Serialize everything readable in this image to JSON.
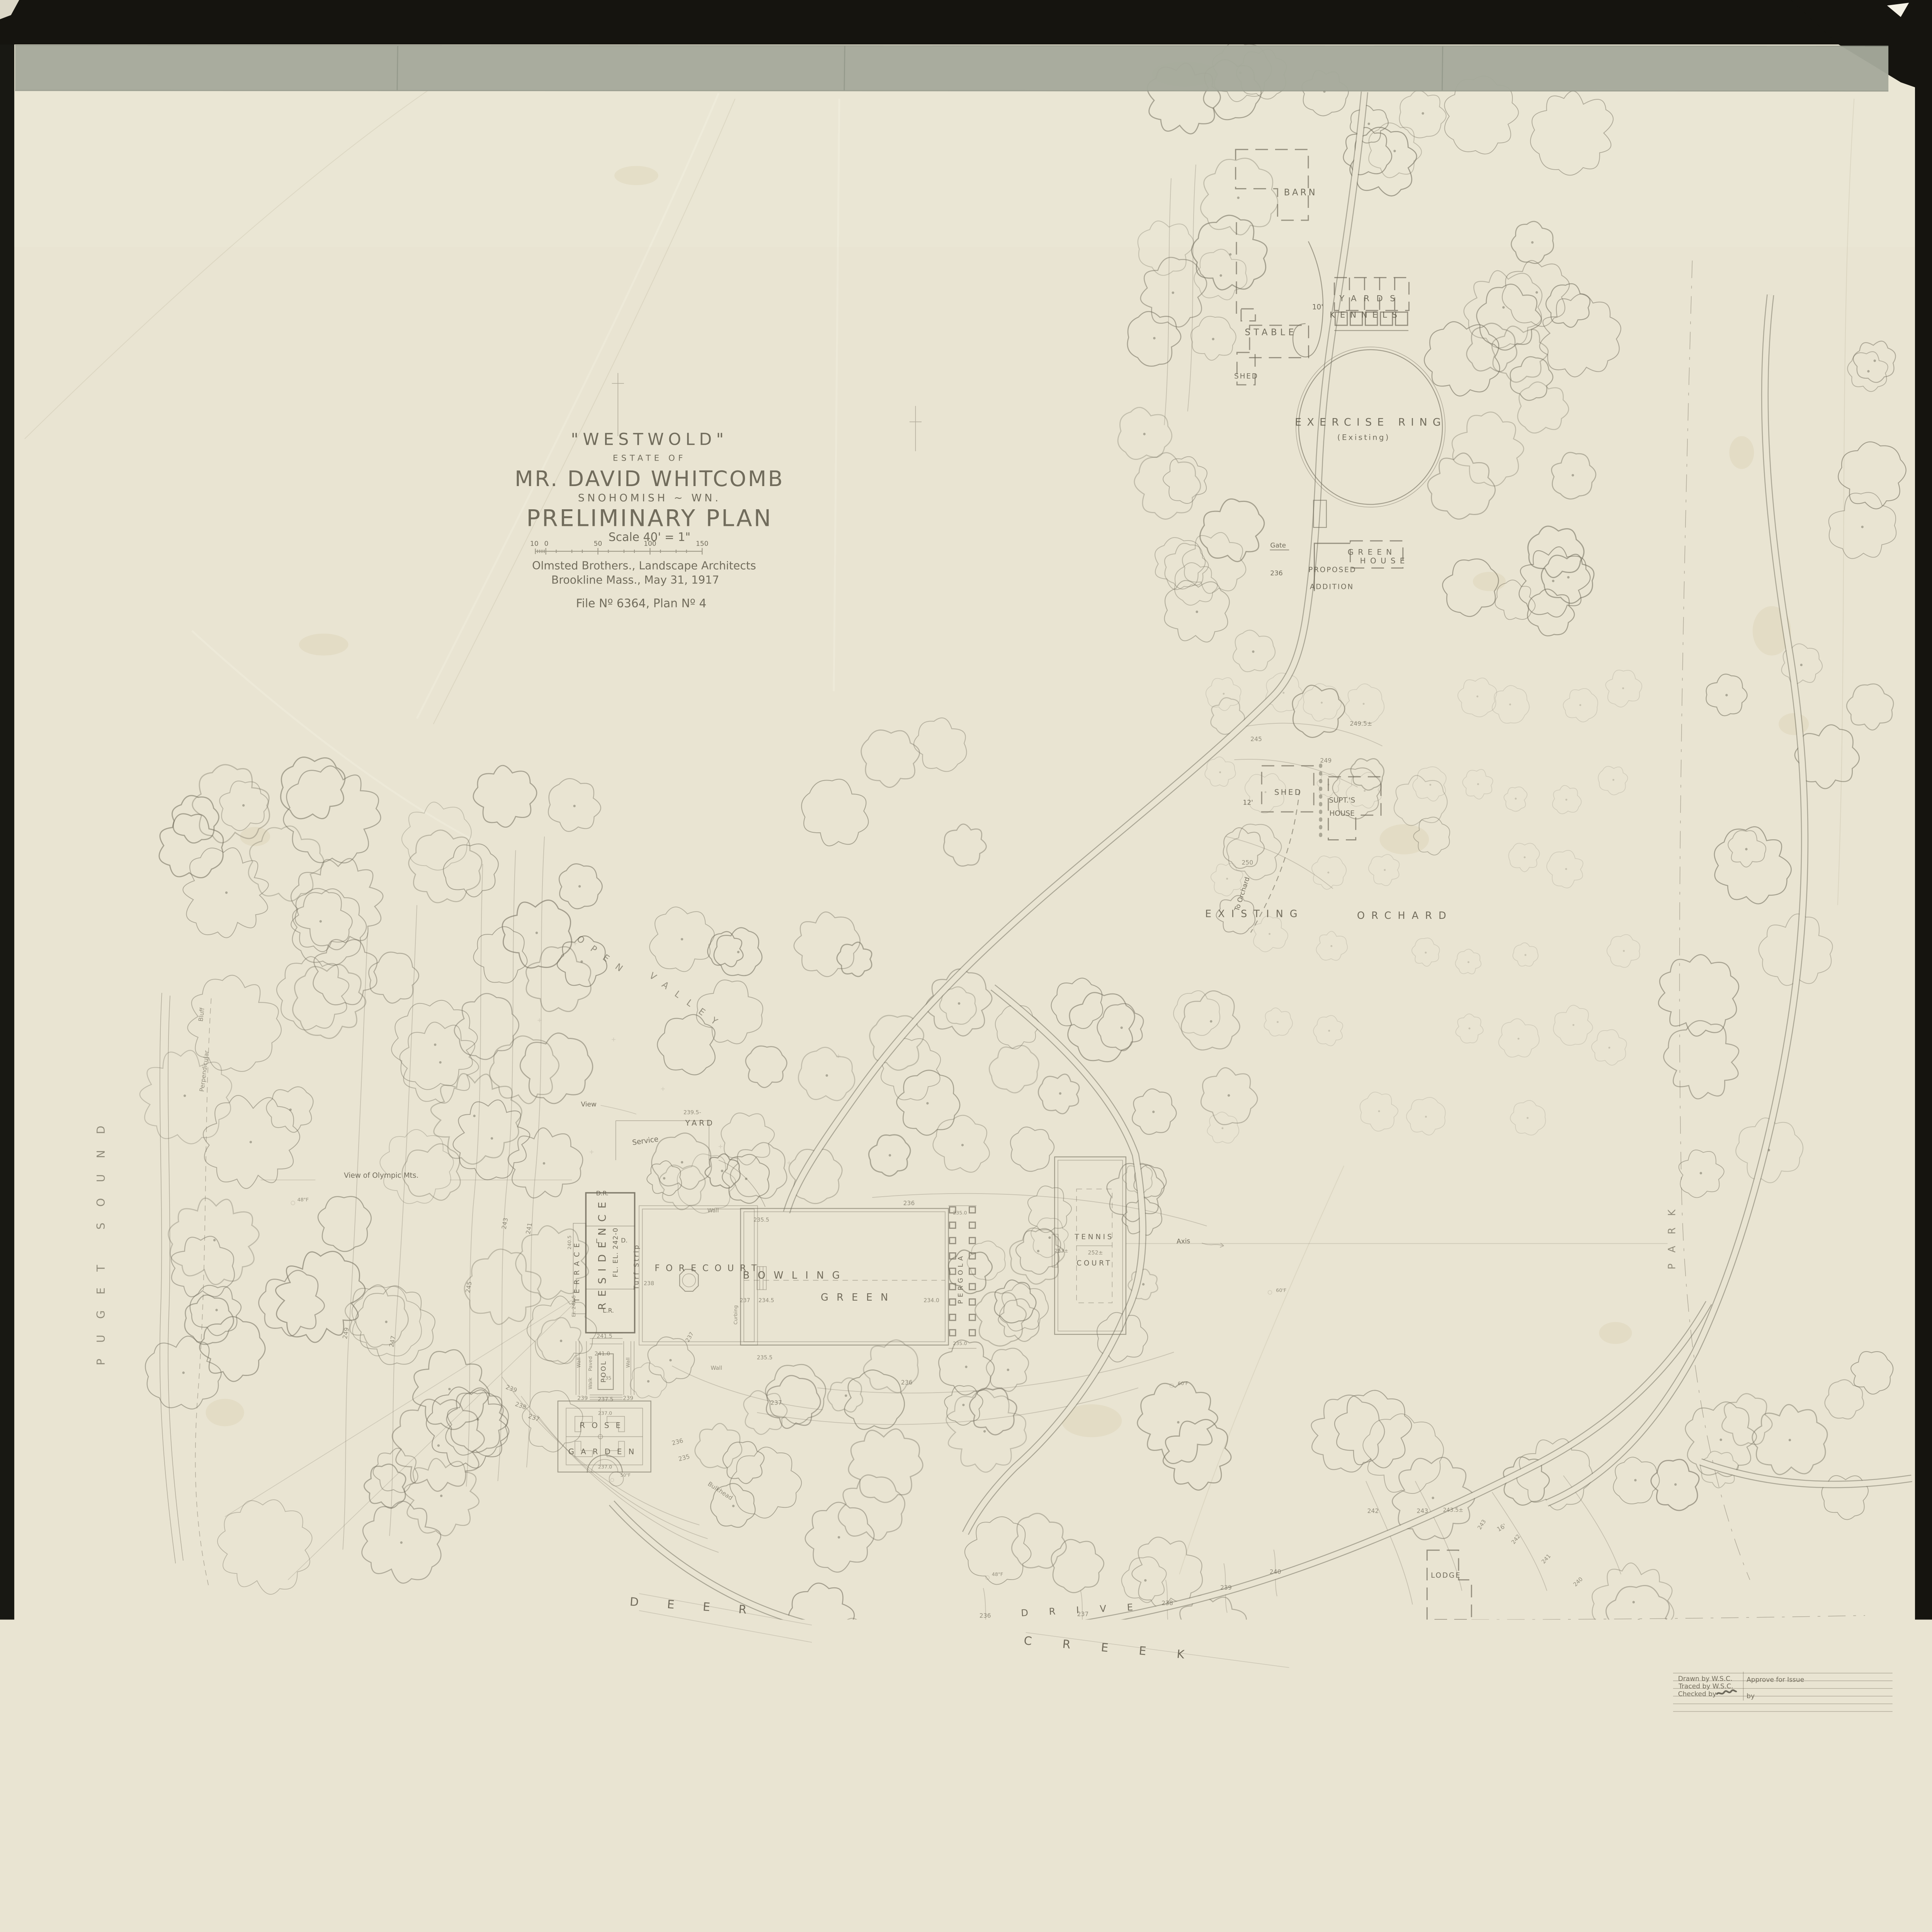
{
  "title_block": {
    "name": "\"WESTWOLD\"",
    "estate_of": "ESTATE OF",
    "owner": "MR. DAVID WHITCOMB",
    "location": "SNOHOMISH ~ WN.",
    "plan_type": "PRELIMINARY PLAN",
    "scale": "Scale 40' = 1\"",
    "scale_ticks": [
      "10",
      "0",
      "50",
      "100",
      "150"
    ],
    "firm_line1": "Olmsted Brothers., Landscape Architects",
    "firm_line2": "Brookline Mass., May 31, 1917",
    "file_line": "File Nº 6364, Plan Nº 4"
  },
  "farmstead": {
    "barn": "BARN",
    "stable": "STABLE",
    "shed": "SHED",
    "yards": "YARDS",
    "kennels": "KENNELS",
    "road_width_10": "10'",
    "ring_line1": "EXERCISE RING",
    "ring_line2": "(Existing)",
    "green": "GREEN",
    "house": "HOUSE",
    "proposed": "PROPOSED",
    "addition": "ADDITION",
    "gate": "Gate",
    "c236": "236"
  },
  "superintendent": {
    "shed": "SHED",
    "supts": "SUPT.'S",
    "house": "HOUSE",
    "to_orchard": "To Orchard",
    "road_width_12": "12'",
    "c245": "245",
    "c249": "249",
    "c249_5": "249.5±",
    "c250": "250"
  },
  "orchard": {
    "word1": "EXISTING",
    "word2": "ORCHARD"
  },
  "valley": {
    "word1": "OPEN",
    "word2": "VALLEY",
    "view": "View"
  },
  "views": {
    "olympic": "View of Olympic Mts.",
    "puget_sound": "PUGET SOUND",
    "park": "PARK",
    "perpendicular": "Perpendicular",
    "bluff": "Bluff"
  },
  "residence": {
    "label": "RESIDENCE",
    "floor_elev": "FL. EL. 242-0",
    "terrace": "TERRACE",
    "dr": "D.R.",
    "l": "L.",
    "d": "D.",
    "lr": "L.R.",
    "service": "Service",
    "yard": "YARD",
    "turf_strip": "Turf Strip",
    "forecourt": "FORECOURT",
    "wall": "Wall",
    "curbing": "Curbing",
    "el_241_5": "El. 241.5",
    "e240_5": "240.5",
    "e241_5": "241.5",
    "e241_0": "241.0",
    "e239_5": "239.5-",
    "e238": "238"
  },
  "bowling": {
    "word1": "BOWLING",
    "word2": "GREEN",
    "pergola": "PERGOLA",
    "e235_5": "235.5",
    "e237": "237",
    "e234_5": "234.5",
    "e234_0": "234.0",
    "e235_0": "235.0",
    "c236": "236",
    "c237": "237"
  },
  "garden": {
    "pool": "POOL",
    "paved": "Paved",
    "walk": "Walk",
    "wall": "Wall",
    "rose1": "ROSE",
    "rose2": "GARDEN",
    "e237_0": "237.0",
    "e237_5": "237.5",
    "e239": "239",
    "e235": "235",
    "tree_50": "50\"F",
    "bulkhead": "Bulkhead",
    "c235": "235",
    "c236": "236",
    "c237": "237",
    "c238": "238",
    "c239": "239"
  },
  "tennis": {
    "word1": "TENNIS",
    "word2": "COURT",
    "e252": "252±",
    "e253": "253±",
    "axis": "Axis",
    "tree_60": "60'F"
  },
  "drive": {
    "word": "DRIVE",
    "width_16": "16'",
    "lodge": "LODGE",
    "e243_5": "243.5±",
    "c236": "236",
    "c237": "237",
    "c238": "238",
    "c239": "239",
    "c240": "240",
    "c241": "241",
    "c242": "242",
    "c243": "243"
  },
  "creek": {
    "deer": "DEER",
    "creek": "CREEK"
  },
  "slope": {
    "c241": "241",
    "c243": "243",
    "c245": "245",
    "c247": "247",
    "c249": "249",
    "tree_48": "48\"F"
  },
  "corner_notes": {
    "drawn": "Drawn by W.S.C.",
    "traced": "Traced by W.S.C.",
    "checked": "Checked by",
    "approve": "Approve for Issue",
    "by": "by"
  }
}
